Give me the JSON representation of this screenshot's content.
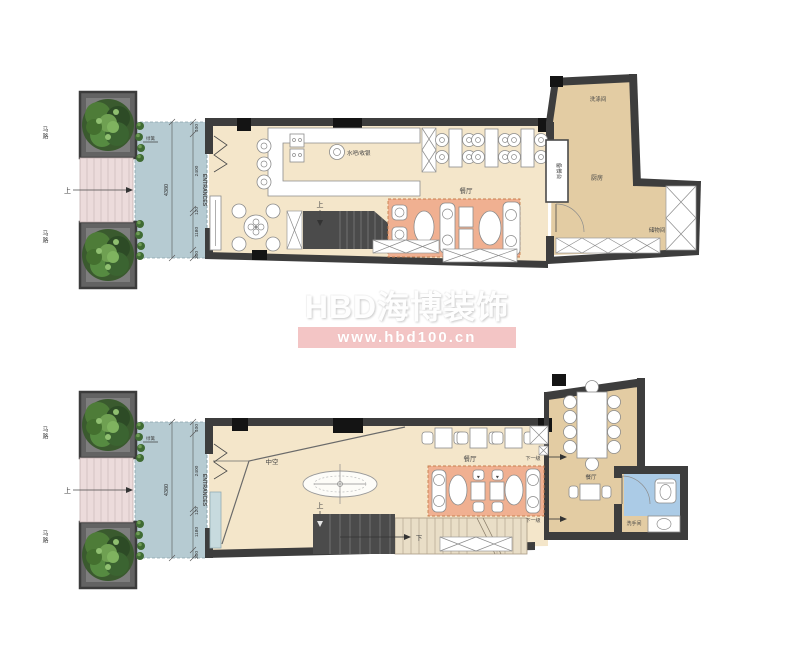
{
  "watermark": {
    "brand": "HBD海博装饰",
    "url": "www.hbd100.cn"
  },
  "labels": {
    "road": "马路",
    "up": "上",
    "down": "下",
    "down_one_step": "下一级",
    "hedge": "绿篱",
    "entrance_en": "ENTRANCES",
    "entrance_cn": "主入口",
    "dining": "餐厅",
    "kitchen": "厨房",
    "washing_room": "洗涤间",
    "storage": "储物间",
    "serving_counter": "备餐台",
    "bar_cashier": "水吧/收银",
    "void": "中空",
    "washroom": "洗手间"
  },
  "dimensions": {
    "total": "4380",
    "segments": [
      "400",
      "2400",
      "120",
      "1180",
      "300"
    ]
  },
  "colors": {
    "floor_light": "#f4e6ca",
    "floor_dark": "#e3cca3",
    "wall": "#3d3d3d",
    "deck": "#b6cbd2",
    "steps": "#ecdbdb",
    "booth": "#f0b091",
    "washroom_floor": "#abcbe6",
    "stairs": "#4b4b4b",
    "tree_green": "#3a5a2e",
    "watermark_bar": "#f3c5c5"
  }
}
